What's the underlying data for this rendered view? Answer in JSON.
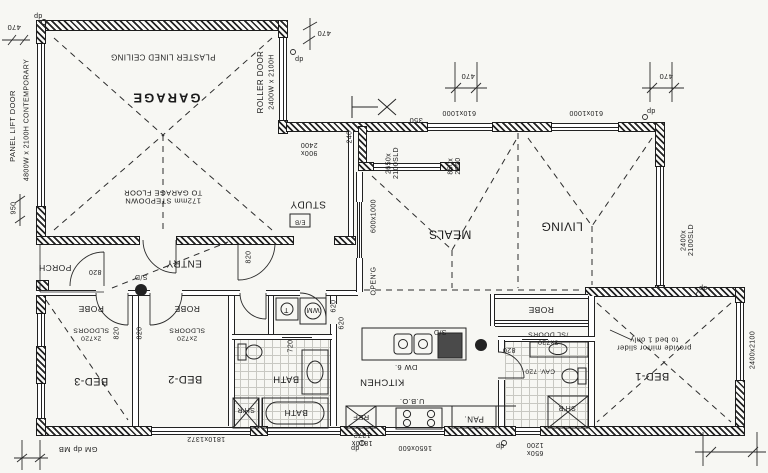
{
  "drawing": {
    "kind": "residential floor plan, printed rotated 180 degrees",
    "ink": "#1d1d1d",
    "paper": "#f7f7f3"
  },
  "rooms": [
    "GARAGE",
    "STUDY",
    "MEALS",
    "LIVING",
    "ENTRY",
    "PORCH",
    "BED-1",
    "BED-2",
    "BED-3",
    "BATH",
    "KITCHEN"
  ],
  "labels": [
    {
      "name": "room-garage",
      "text": "GARAGE",
      "x": 166,
      "y": 97,
      "o": "h",
      "s": 13,
      "big": true
    },
    {
      "name": "garage-ceiling-note",
      "text": "PLASTER LINED CEILING",
      "x": 163,
      "y": 56,
      "o": "h",
      "s": 8
    },
    {
      "name": "garage-stepdown-note",
      "text": "172mm STEPDOWN\nTO GARAGE FLOOR",
      "x": 163,
      "y": 196,
      "o": "h",
      "s": 7.5
    },
    {
      "name": "roller-door",
      "text": "ROLLER DOOR",
      "x": 261,
      "y": 82,
      "o": "v",
      "s": 8
    },
    {
      "name": "roller-door-size",
      "text": "2400W x 2100H",
      "x": 272,
      "y": 82,
      "o": "v",
      "s": 7
    },
    {
      "name": "panel-lift-door-size",
      "text": "4800W x 2100H CONTEMPORARY",
      "x": 27,
      "y": 120,
      "o": "v",
      "s": 7
    },
    {
      "name": "panel-lift-door",
      "text": "PANEL LIFT DOOR",
      "x": 13,
      "y": 126,
      "o": "v",
      "s": 7.5
    },
    {
      "name": "room-study",
      "text": "STUDY",
      "x": 308,
      "y": 204,
      "o": "h",
      "s": 10
    },
    {
      "name": "room-meals",
      "text": "MEALS",
      "x": 450,
      "y": 234,
      "o": "h",
      "s": 12
    },
    {
      "name": "room-living",
      "text": "LIVING",
      "x": 562,
      "y": 226,
      "o": "h",
      "s": 12
    },
    {
      "name": "room-entry",
      "text": "ENTRY",
      "x": 184,
      "y": 263,
      "o": "h",
      "s": 10
    },
    {
      "name": "room-porch",
      "text": "PORCH",
      "x": 55,
      "y": 267,
      "o": "h",
      "s": 8.5
    },
    {
      "name": "room-bed3",
      "text": "BED-3",
      "x": 91,
      "y": 381,
      "o": "h",
      "s": 11
    },
    {
      "name": "room-bed2",
      "text": "BED-2",
      "x": 185,
      "y": 379,
      "o": "h",
      "s": 11
    },
    {
      "name": "room-bed1",
      "text": "BED-1",
      "x": 652,
      "y": 376,
      "o": "h",
      "s": 11
    },
    {
      "name": "room-bath",
      "text": "BATH",
      "x": 286,
      "y": 378,
      "o": "h",
      "s": 9.5
    },
    {
      "name": "room-kitchen",
      "text": "KITCHEN",
      "x": 382,
      "y": 381,
      "o": "h",
      "s": 9.5
    },
    {
      "name": "robe-bed3",
      "text": "ROBE",
      "x": 91,
      "y": 308,
      "o": "h",
      "s": 8.5
    },
    {
      "name": "robe-bed3-doors",
      "text": "2x720\nSLDOORS",
      "x": 91,
      "y": 334,
      "o": "h",
      "s": 6.8
    },
    {
      "name": "robe-bed2",
      "text": "ROBE",
      "x": 187,
      "y": 308,
      "o": "h",
      "s": 8.5
    },
    {
      "name": "robe-bed2-doors",
      "text": "2x720\nSLDOORS",
      "x": 187,
      "y": 334,
      "o": "h",
      "s": 6.8
    },
    {
      "name": "robe-bed1",
      "text": "ROBE",
      "x": 541,
      "y": 309,
      "o": "h",
      "s": 8.5
    },
    {
      "name": "robe-bed1-doors",
      "text": "3x720\n/SL DOORS",
      "x": 548,
      "y": 338,
      "o": "h",
      "s": 6.8
    },
    {
      "name": "mirror-slider-note",
      "text": "provide mirror slider\nto bed 1 only",
      "x": 654,
      "y": 343,
      "o": "h",
      "s": 7.5
    },
    {
      "name": "smoke-detector-hall",
      "text": "S/D",
      "x": 141,
      "y": 276,
      "o": "h",
      "s": 7
    },
    {
      "name": "smoke-detector-kitchen",
      "text": "S/D",
      "x": 440,
      "y": 331,
      "o": "h",
      "s": 7
    },
    {
      "name": "dishwasher",
      "text": "DW 6.",
      "x": 406,
      "y": 367,
      "o": "h",
      "s": 7.5
    },
    {
      "name": "under-bench-oven",
      "text": "U.B.O.",
      "x": 412,
      "y": 401,
      "o": "h",
      "s": 7.5
    },
    {
      "name": "pantry",
      "text": "PAN.",
      "x": 474,
      "y": 418,
      "o": "h",
      "s": 8
    },
    {
      "name": "fridge",
      "text": "REF",
      "x": 361,
      "y": 417,
      "o": "h",
      "s": 7.5
    },
    {
      "name": "washing-machine",
      "text": "WM",
      "x": 313,
      "y": 309,
      "o": "h",
      "s": 7
    },
    {
      "name": "trough",
      "text": "T",
      "x": 286,
      "y": 309,
      "o": "h",
      "s": 7
    },
    {
      "name": "bath-tub",
      "text": "BATH",
      "x": 296,
      "y": 412,
      "o": "h",
      "s": 8.5
    },
    {
      "name": "shower-bath",
      "text": "SH'R",
      "x": 246,
      "y": 409,
      "o": "h",
      "s": 7
    },
    {
      "name": "shower-ens",
      "text": "SH'R",
      "x": 567,
      "y": 407,
      "o": "h",
      "s": 7
    },
    {
      "name": "cavity-door-ens",
      "text": "CAV. 720",
      "x": 540,
      "y": 371,
      "o": "h",
      "s": 6.5
    },
    {
      "name": "elec-board",
      "text": "E/B",
      "x": 300,
      "y": 221,
      "o": "h",
      "s": 6
    },
    {
      "name": "door-820-entry",
      "text": "820",
      "x": 95,
      "y": 271,
      "o": "h",
      "s": 7
    },
    {
      "name": "door-820-meals",
      "text": "820",
      "x": 249,
      "y": 257,
      "o": "v",
      "s": 7
    },
    {
      "name": "door-820-bed3",
      "text": "820",
      "x": 117,
      "y": 333,
      "o": "v",
      "s": 7
    },
    {
      "name": "door-820-bed2",
      "text": "820",
      "x": 140,
      "y": 333,
      "o": "v",
      "s": 7
    },
    {
      "name": "door-820-ens",
      "text": "820",
      "x": 509,
      "y": 349,
      "o": "h",
      "s": 7
    },
    {
      "name": "door-620-wc",
      "text": "620",
      "x": 334,
      "y": 306,
      "o": "v",
      "s": 7
    },
    {
      "name": "door-620-laundry",
      "text": "620",
      "x": 342,
      "y": 323,
      "o": "v",
      "s": 7
    },
    {
      "name": "door-720-bath",
      "text": "720",
      "x": 291,
      "y": 346,
      "o": "v",
      "s": 7
    },
    {
      "name": "window-610x1000-a",
      "text": "610x1000",
      "x": 459,
      "y": 112,
      "o": "h",
      "s": 7
    },
    {
      "name": "window-610x1000-b",
      "text": "610x1000",
      "x": 586,
      "y": 112,
      "o": "h",
      "s": 7
    },
    {
      "name": "dim-470-a",
      "text": "470",
      "x": 468,
      "y": 76,
      "o": "h",
      "s": 7.5
    },
    {
      "name": "dim-470-b",
      "text": "470",
      "x": 666,
      "y": 76,
      "o": "h",
      "s": 7.5
    },
    {
      "name": "dim-470-c",
      "text": "470",
      "x": 324,
      "y": 33,
      "o": "h",
      "s": 7.5
    },
    {
      "name": "dim-470-d",
      "text": "470",
      "x": 14,
      "y": 27,
      "o": "h",
      "s": 7.5
    },
    {
      "name": "sliding-door-2650",
      "text": "2650x\n2100SLD",
      "x": 393,
      "y": 163,
      "o": "v",
      "s": 7
    },
    {
      "name": "dim-350",
      "text": "350",
      "x": 416,
      "y": 120,
      "o": "h",
      "s": 7.5
    },
    {
      "name": "window-850x2050",
      "text": "850x\n2050",
      "x": 455,
      "y": 166,
      "o": "v",
      "s": 7
    },
    {
      "name": "study-opening-900x2400",
      "text": "900x\n2400",
      "x": 309,
      "y": 148,
      "o": "h",
      "s": 7
    },
    {
      "name": "dim-240",
      "text": "240",
      "x": 350,
      "y": 137,
      "o": "v",
      "s": 7
    },
    {
      "name": "window-600x1000",
      "text": "600x1000",
      "x": 374,
      "y": 216,
      "o": "v",
      "s": 7
    },
    {
      "name": "opening-label",
      "text": "OPEN'G",
      "x": 374,
      "y": 281,
      "o": "v",
      "s": 7
    },
    {
      "name": "window-1810x1372-a",
      "text": "1810x1372",
      "x": 206,
      "y": 438,
      "o": "h",
      "s": 7
    },
    {
      "name": "window-1810x1372-b",
      "text": "1810x\n1372",
      "x": 362,
      "y": 438,
      "o": "h",
      "s": 7
    },
    {
      "name": "window-1650x600",
      "text": "1650x600",
      "x": 415,
      "y": 447,
      "o": "h",
      "s": 7
    },
    {
      "name": "window-650x1200",
      "text": "650x\n1200",
      "x": 535,
      "y": 448,
      "o": "h",
      "s": 7
    },
    {
      "name": "sliding-door-2400",
      "text": "2400x\n2100SLD",
      "x": 688,
      "y": 240,
      "o": "v",
      "s": 7
    },
    {
      "name": "window-2400x2100",
      "text": "2400x2100",
      "x": 753,
      "y": 350,
      "o": "v",
      "s": 7
    },
    {
      "name": "gas-meter-downpipe-meterbox",
      "text": "GM dp MB",
      "x": 78,
      "y": 449,
      "o": "h",
      "s": 7.5
    },
    {
      "name": "dim-950",
      "text": "950",
      "x": 14,
      "y": 208,
      "o": "v",
      "s": 7
    },
    {
      "name": "downpipe-a",
      "text": "dp",
      "x": 38,
      "y": 15,
      "o": "h",
      "s": 7
    },
    {
      "name": "downpipe-b",
      "text": "dp",
      "x": 299,
      "y": 58,
      "o": "h",
      "s": 7
    },
    {
      "name": "downpipe-c",
      "text": "dp",
      "x": 651,
      "y": 110,
      "o": "h",
      "s": 7
    },
    {
      "name": "downpipe-d",
      "text": "dp",
      "x": 703,
      "y": 287,
      "o": "h",
      "s": 7
    },
    {
      "name": "downpipe-e",
      "text": "dp",
      "x": 355,
      "y": 447,
      "o": "h",
      "s": 7
    },
    {
      "name": "downpipe-f",
      "text": "dp",
      "x": 500,
      "y": 445,
      "o": "h",
      "s": 7
    }
  ]
}
